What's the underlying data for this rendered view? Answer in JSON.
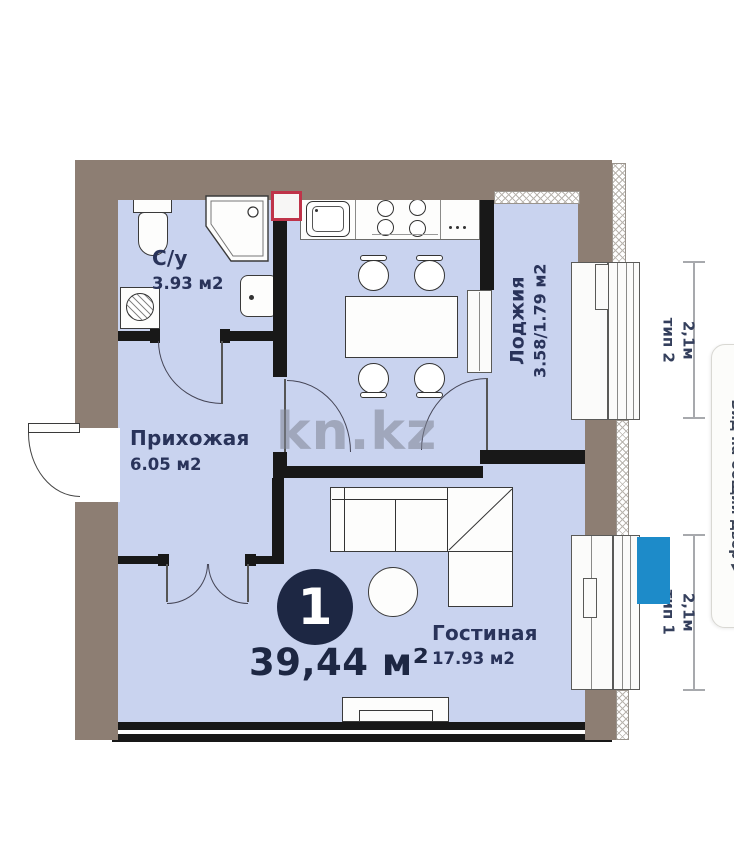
{
  "watermark": "kn.kz",
  "total": {
    "rooms_badge": "1",
    "area": "39,44 м²"
  },
  "rooms": [
    {
      "name": "С/у",
      "area": "3.93 м2"
    },
    {
      "name": "Прихожая",
      "area": "6.05 м2"
    },
    {
      "name": "Гостиная",
      "area": "17.93 м2"
    },
    {
      "name": "Лоджия",
      "area": "3.58/1.79 м2"
    }
  ],
  "window_dimensions": [
    {
      "size": "2,1м",
      "type": "тип 2"
    },
    {
      "size": "2,1м",
      "type": "тип 1"
    }
  ],
  "side_note": {
    "text": "Вид на общий двор",
    "arrow": "▶"
  },
  "colors": {
    "interior": "#c9d3ef",
    "outer_wall": "#8d7e73",
    "inner_wall": "#181818",
    "accent_navy": "#1d2743",
    "marker_blue": "#1d8bc9",
    "vent_red": "#bf3349"
  }
}
